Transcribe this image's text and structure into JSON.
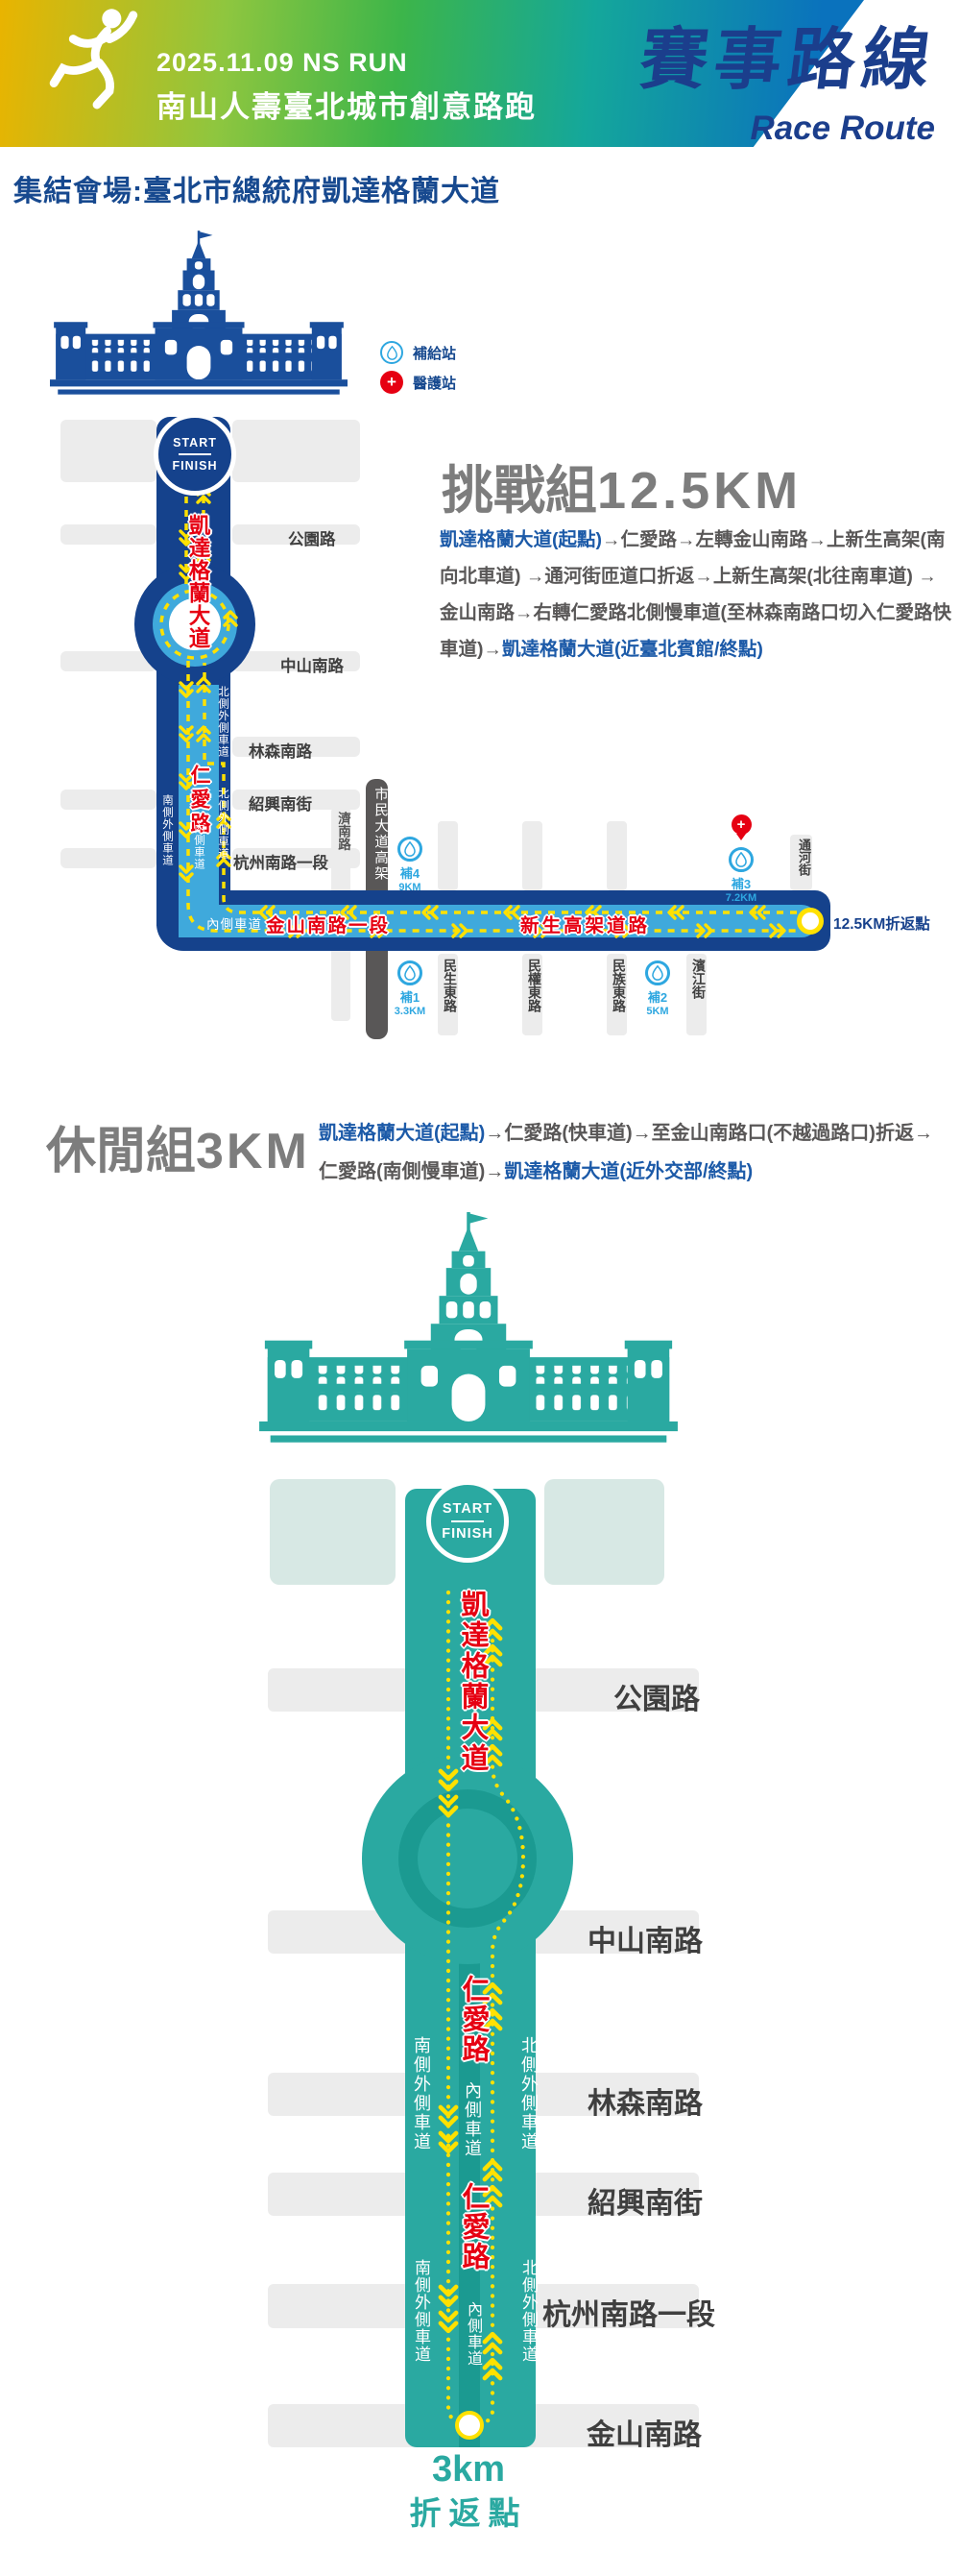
{
  "header": {
    "date": "2025.11.09 NS RUN",
    "event": "南山人壽臺北城市創意路跑",
    "title": "賽事路線",
    "subtitle": "Race Route"
  },
  "assembly": "集結會場:臺北市總統府凱達格蘭大道",
  "legend": {
    "supply": "補給站",
    "medical": "醫護站"
  },
  "start_label": "START",
  "finish_label": "FINISH",
  "challenge": {
    "group": "挑戰組",
    "distance": "12.5KM",
    "route_desc": {
      "start_part": "凱達格蘭大道(起點)",
      "mid": "→仁愛路→左轉金山南路→上新生高架(南向北車道) →通河街匝道口折返→上新生高架(北往南車道) →金山南路→右轉仁愛路北側慢車道(至林森南路口切入仁愛路快車道)→",
      "end_part": "凱達格蘭大道(近臺北賓館/終點)"
    },
    "map": {
      "kaidagelan": "凱達格蘭大道",
      "renai": "仁愛路",
      "streets": [
        "公園路",
        "中山南路",
        "林森南路",
        "紹興南街",
        "杭州南路一段"
      ],
      "lane_north": "北側外側車道",
      "lane_south": "南側外側車道",
      "lane_inner": "內側車道",
      "jinan": "濟南路",
      "civic": "市民大道高架",
      "jinshan": "金山南路一段",
      "xinsheng": "新生高架道路",
      "turnaround": "12.5KM折返點",
      "tonghe": "通河街",
      "cross_streets": [
        "民生東路",
        "民權東路",
        "民族東路",
        "濱江街"
      ],
      "stations": [
        {
          "name": "補1",
          "km": "3.3KM"
        },
        {
          "name": "補2",
          "km": "5KM"
        },
        {
          "name": "補3",
          "km": "7.2KM"
        },
        {
          "name": "補4",
          "km": "9KM"
        }
      ]
    }
  },
  "leisure": {
    "group": "休閒組",
    "distance": "3KM",
    "route_desc": {
      "start_part": "凱達格蘭大道(起點)",
      "mid": "→仁愛路(快車道)→至金山南路口(不越過路口)折返→仁愛路(南側慢車道)→",
      "end_part": "凱達格蘭大道(近外交部/終點)"
    },
    "map": {
      "kaidagelan": "凱達格蘭大道",
      "renai": "仁愛路",
      "streets": [
        "公園路",
        "中山南路",
        "林森南路",
        "紹興南街",
        "杭州南路一段",
        "金山南路"
      ],
      "lane_north": "北側外側車道",
      "lane_south": "南側外側車道",
      "lane_inner": "內側車道",
      "turnaround_line1": "3km",
      "turnaround_line2": "折返點"
    }
  },
  "colors": {
    "banner_yellow": "#e9b400",
    "banner_green": "#3cb54a",
    "banner_blue": "#0a72bd",
    "navy_road": "#15428c",
    "light_blue_lane": "#3fa9dc",
    "teal_road": "#2aa9a1",
    "teal_dark_lane": "#1b9a91",
    "route_yellow": "#ffe100",
    "red_text": "#e60012",
    "title_navy": "#1b3e8c",
    "desc_blue": "#1c5aa8",
    "gray_bar": "#ececec",
    "civic_gray": "#595757",
    "station_blue": "#2ea7e0",
    "section_gray": "#7d7d7d"
  }
}
